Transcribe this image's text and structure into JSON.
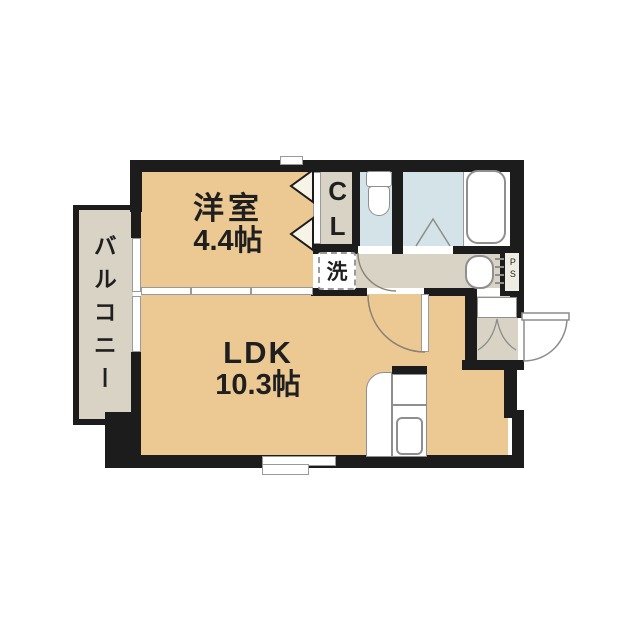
{
  "floorplan": {
    "labels": {
      "western_room_name": "洋室",
      "western_room_size": "4.4帖",
      "ldk_name": "LDK",
      "ldk_size": "10.3帖",
      "balcony": "バルコニー",
      "closet": "CL",
      "washing_machine": "洗",
      "pipe_space": "PS"
    },
    "colors": {
      "room_floor": "#ecc992",
      "service_floor": "#d8d3c5",
      "wet_area_floor": "#d4e3e8",
      "wall": "#1c1c1c",
      "fixture_outline": "#8f8f8f",
      "door_arc": "#8c8274",
      "background": "#ffffff"
    }
  }
}
